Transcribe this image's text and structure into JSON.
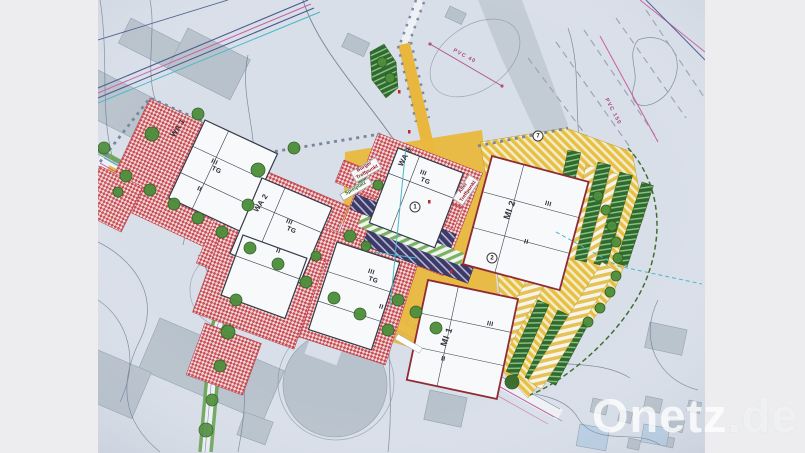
{
  "watermark": {
    "brand": "Onetz",
    "tld": ".de"
  },
  "plan": {
    "zones": {
      "wa1": "WA 1",
      "wa2": "WA 2",
      "wa3": "WA 3",
      "mi1": "MI 1",
      "mi2": "MI 2"
    },
    "floors": {
      "three": "III",
      "two": "II",
      "tg": "TG"
    },
    "places": {
      "buerger": "Bürger Treffpunkt",
      "spielplatz": "Spielplatz",
      "alter": "Alter Treffpunkt"
    },
    "utilities": {
      "pvc40": "PVC 40",
      "pvc150": "PVC 150"
    },
    "markers": {
      "m1": "1",
      "m2": "2",
      "m7": "7"
    },
    "colors": {
      "paper": "#d9dfe9",
      "residential_red": "#c94a54",
      "road_yellow": "#e9b73d",
      "mixed_yellow": "#e7c043",
      "green": "#4d8e3b",
      "parking_purple": "#3c3a66",
      "utility_pink": "#c85fa2",
      "utility_cyan": "#49b6c6"
    }
  }
}
